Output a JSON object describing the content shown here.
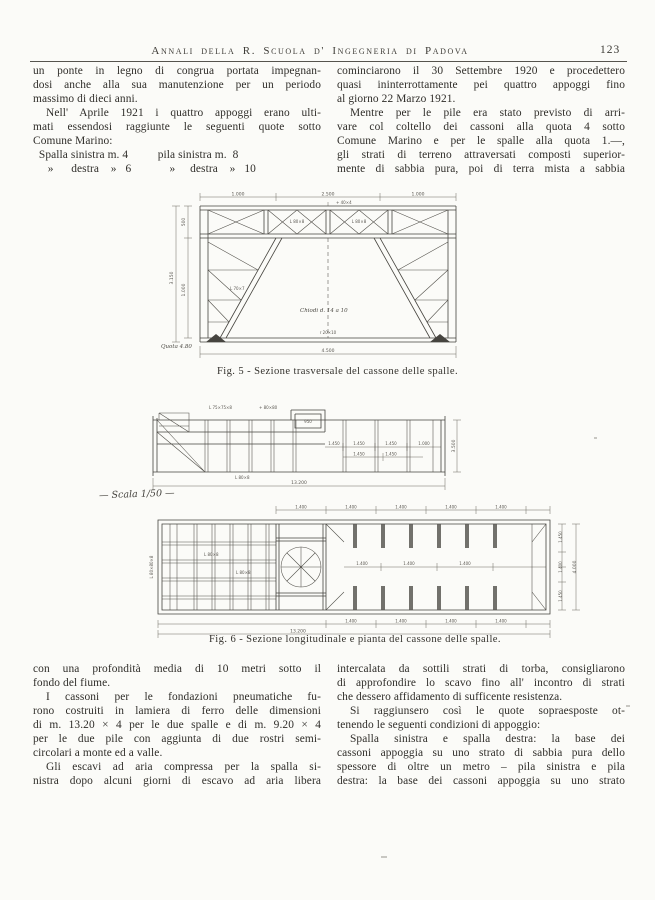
{
  "header": {
    "journal": "Annali della R. Scuola d' Ingegneria di Padova",
    "page_number": "123"
  },
  "text": {
    "top_left": [
      {
        "t": "un ponte in legno di congrua portata impegnan-"
      },
      {
        "t": "dosi anche alla sua manutenzione per un periodo"
      },
      {
        "t": "massimo di dieci anni.",
        "c": "short"
      },
      {
        "t": "Nell' Aprile 1921 i quattro appoggi erano ulti-",
        "c": "ind"
      },
      {
        "t": "mati essendosi raggiunte le seguenti quote sotto"
      },
      {
        "t": "Comune Marino:",
        "c": "short"
      },
      {
        "t": "  Spalla sinistra m. 4          pila sinistra m.  8",
        "c": "pre"
      },
      {
        "t": "     »      destra    »   6             »     destra    »   10",
        "c": "pre"
      }
    ],
    "top_right": [
      {
        "t": "cominciarono il 30 Settembre 1920 e procedettero"
      },
      {
        "t": "quasi ininterrottamente pei quattro appoggi fino"
      },
      {
        "t": "al giorno 22 Marzo 1921.",
        "c": "short"
      },
      {
        "t": "Mentre per le pile era stato previsto di arri-",
        "c": "ind"
      },
      {
        "t": "vare col coltello dei cassoni alla quota 4 sotto"
      },
      {
        "t": "Comune Marino e per le spalle alla quota 1.—,"
      },
      {
        "t": "gli strati di terreno attraversati composti superior-"
      },
      {
        "t": "mente di sabbia pura, poi di terra mista a sabbia"
      }
    ],
    "bottom_left": [
      {
        "t": "con una profondità media di 10 metri sotto il"
      },
      {
        "t": "fondo del fiume.",
        "c": "short"
      },
      {
        "t": "I cassoni per le fondazioni pneumatiche fu-",
        "c": "ind"
      },
      {
        "t": "rono costruiti in lamiera di ferro delle dimensioni"
      },
      {
        "t": "di m. 13.20 × 4 per le due spalle e di m. 9.20 × 4"
      },
      {
        "t": "per le due pile con aggiunta di due rostri semi-"
      },
      {
        "t": "circolari a monte ed a valle.",
        "c": "short"
      },
      {
        "t": "Gli escavi ad aria compressa per la spalla si-",
        "c": "ind"
      },
      {
        "t": "nistra dopo alcuni giorni di escavo ad aria libera"
      }
    ],
    "bottom_right": [
      {
        "t": "intercalata da sottili strati di torba, consigliarono"
      },
      {
        "t": "di approfondire lo scavo fino all' incontro di strati"
      },
      {
        "t": "che dessero affidamento di sufficente resistenza.",
        "c": "short"
      },
      {
        "t": "Si raggiunsero così le quote sopraesposte ot-",
        "c": "ind"
      },
      {
        "t": "tenendo le seguenti condizioni di appoggio:",
        "c": "short"
      },
      {
        "t": "Spalla sinistra e spalla destra: la base dei",
        "c": "ind"
      },
      {
        "t": "cassoni appoggia su uno strato di sabbia pura dello"
      },
      {
        "t": "spessore di oltre un metro – pila sinistra e pila"
      },
      {
        "t": "destra: la base dei cassoni appoggia su uno strato"
      }
    ]
  },
  "figures": {
    "fig5": {
      "caption": "Fig. 5 - Sezione trasversale del cassone delle spalle.",
      "labels": [
        "1.000",
        "2.500",
        "1.000",
        "3.150",
        "500",
        "1.000",
        "4.500",
        "Chiodi d. 14 a 10",
        "Quota 4.80",
        "r 20×10",
        "L 80×8",
        "+ 40×4",
        "L 70×7"
      ]
    },
    "fig6": {
      "caption": "Fig. 6 - Sezione longitudinale e pianta del cassone delle spalle.",
      "scala": "— Scala 1/50 —",
      "section_labels": [
        "13.200",
        "3.500",
        "1.450",
        "1.000",
        "950",
        "L 75×75×8",
        "+ 80×80",
        "L 80×8"
      ],
      "plan_labels": [
        "13.200",
        "1.400",
        "1.450",
        "4.000",
        "L 80×80×8",
        "L 80×8"
      ]
    }
  }
}
